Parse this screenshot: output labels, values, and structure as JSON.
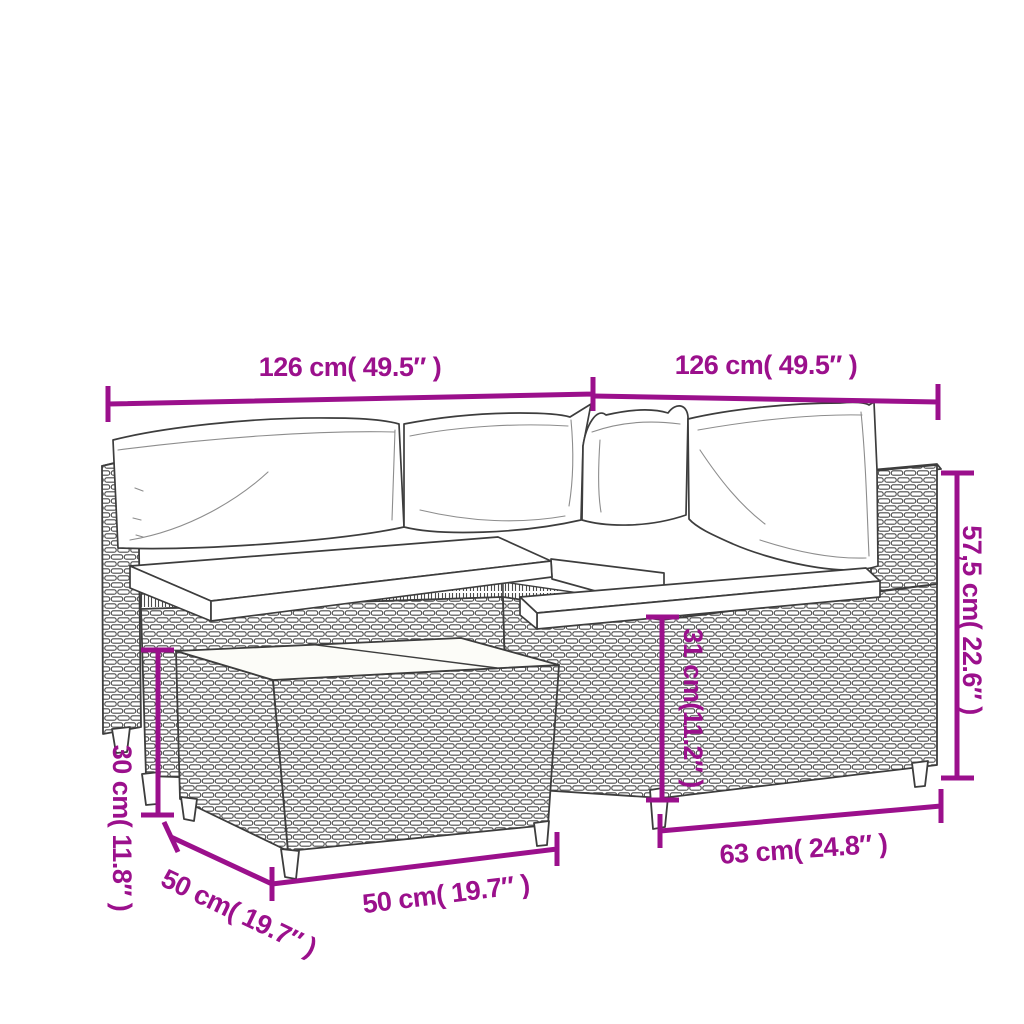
{
  "page": {
    "background": "#ffffff"
  },
  "colors": {
    "dimension_accent": "#9b108c",
    "line_art": "#3d3d3d",
    "cushion_fill": "#ffffff"
  },
  "diagram": {
    "labels": {
      "width_left": "126 cm( 49.5″ )",
      "width_right": "126 cm( 49.5″ )",
      "total_height": "57,5 cm( 22.6″ )",
      "seat_height": "31 cm(11.2″ )",
      "seat_depth": "63 cm( 24.8″ )",
      "table_width": "50 cm( 19.7″ )",
      "table_depth": "50 cm( 19.7″ )",
      "table_height": "30 cm( 11.8″ )"
    }
  }
}
